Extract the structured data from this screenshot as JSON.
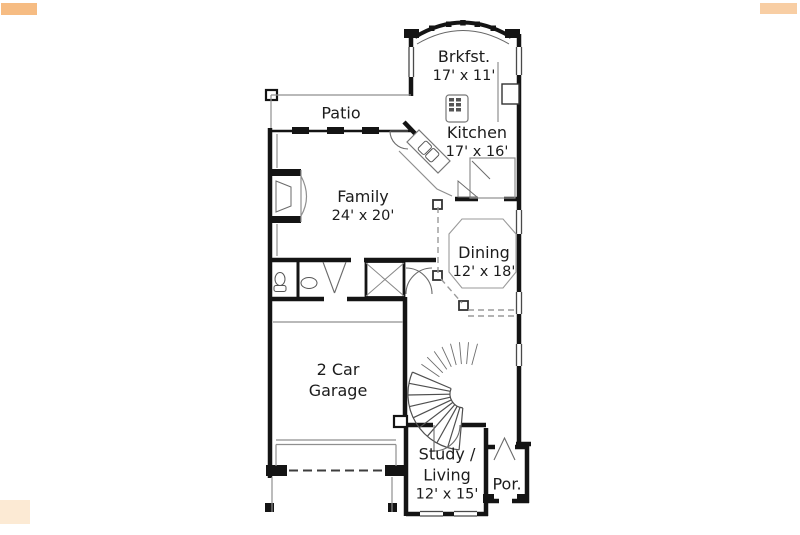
{
  "colors": {
    "wall": "#141414",
    "thin_line": "#8f8f8f",
    "dashed_line": "#9a9a9a",
    "text": "#1c1c1c",
    "watermark": "#f3a659",
    "background": "#ffffff"
  },
  "rooms": {
    "brkfst": {
      "name": "Brkfst.",
      "dims": "17' x 11'"
    },
    "patio": {
      "name": "Patio"
    },
    "kitchen": {
      "name": "Kitchen",
      "dims": "17' x 16'"
    },
    "family": {
      "name": "Family",
      "dims": "24' x 20'"
    },
    "dining": {
      "name": "Dining",
      "dims": "12' x 18'"
    },
    "garage": {
      "line1": "2 Car",
      "line2": "Garage"
    },
    "study": {
      "line1": "Study /",
      "line2": "Living",
      "dims": "12' x 15'"
    },
    "porch": {
      "name": "Por."
    }
  }
}
